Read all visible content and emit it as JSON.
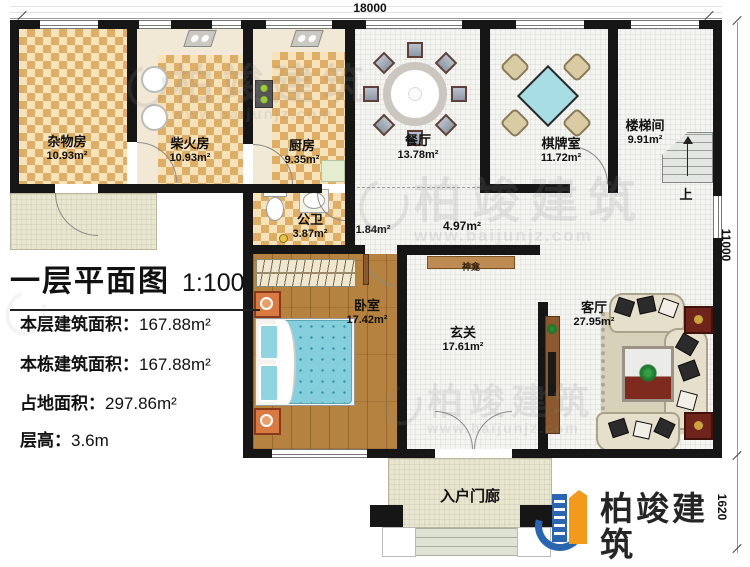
{
  "title": {
    "main": "一层平面图",
    "scale": "1:100"
  },
  "stats": [
    {
      "label": "本层建筑面积：",
      "value": "167.88m²"
    },
    {
      "label": "本栋建筑面积：",
      "value": "167.88m²"
    },
    {
      "label": "占地面积：",
      "value": "297.86m²"
    },
    {
      "label": "层高：",
      "value": "3.6m"
    }
  ],
  "dimensions": {
    "top": "18000",
    "right": "11000",
    "porch": "1620"
  },
  "rooms": [
    {
      "name": "杂物房",
      "area": "10.93m²"
    },
    {
      "name": "柴火房",
      "area": "10.93m²"
    },
    {
      "name": "厨房",
      "area": "9.35m²"
    },
    {
      "name": "餐厅",
      "area": "13.78m²"
    },
    {
      "name": "棋牌室",
      "area": "11.72m²"
    },
    {
      "name": "楼梯间",
      "area": "9.91m²"
    },
    {
      "name": "公卫",
      "area": "3.87m²"
    },
    {
      "name": "卧室",
      "area": "17.42m²"
    },
    {
      "name": "玄关",
      "area": "17.61m²"
    },
    {
      "name": "客厅",
      "area": "27.95m²"
    }
  ],
  "passages": {
    "small": "1.84m²",
    "hall": "4.97m²"
  },
  "labels": {
    "shrine": "神龛",
    "stairs_up": "上",
    "porch": "入户门廊"
  },
  "brand": {
    "name": "柏竣建筑",
    "url": "www.baijunjz.com"
  },
  "colors": {
    "wall": "#161616",
    "checker_dark": "#dfae66",
    "checker_light": "#f6e2bb",
    "wood": "#b5823f",
    "bed": "#85cfdc",
    "accent_red": "#7e2a1e",
    "brand_blue": "#2a66b0",
    "brand_orange": "#f19a1c"
  }
}
